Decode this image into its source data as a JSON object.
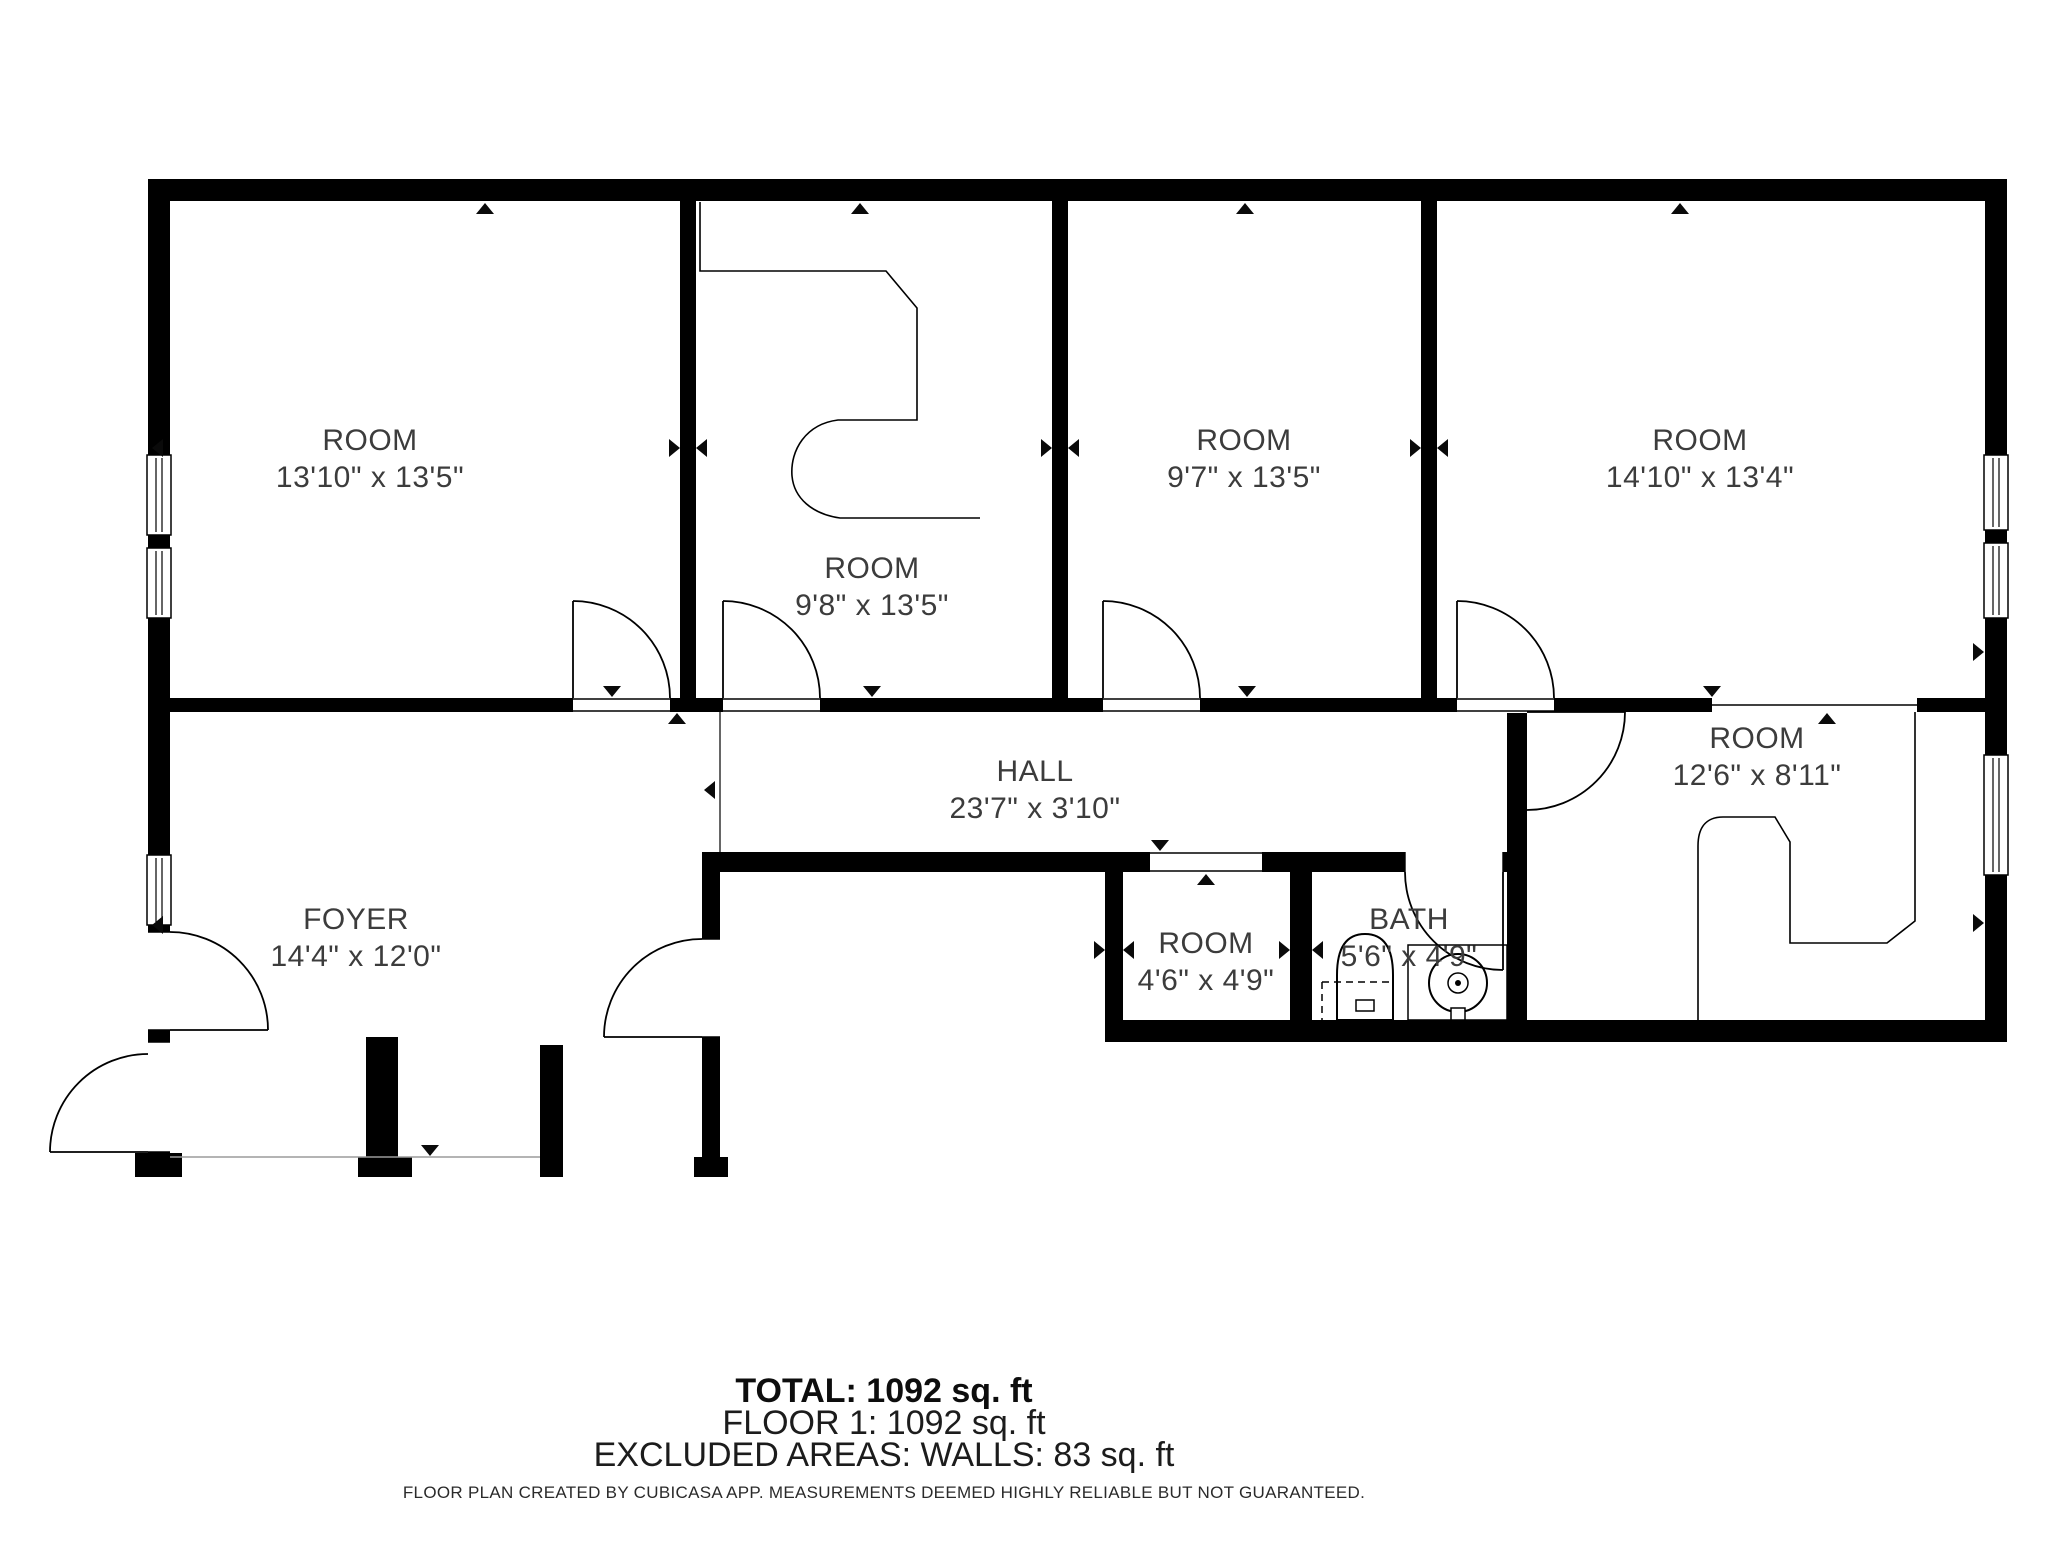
{
  "plan": {
    "rooms": [
      {
        "name": "ROOM",
        "dims": "13'10\" x 13'5\""
      },
      {
        "name": "ROOM",
        "dims": "9'8\" x 13'5\""
      },
      {
        "name": "ROOM",
        "dims": "9'7\" x 13'5\""
      },
      {
        "name": "ROOM",
        "dims": "14'10\" x 13'4\""
      },
      {
        "name": "HALL",
        "dims": "23'7\" x 3'10\""
      },
      {
        "name": "FOYER",
        "dims": "14'4\" x 12'0\""
      },
      {
        "name": "ROOM",
        "dims": "4'6\" x 4'9\""
      },
      {
        "name": "BATH",
        "dims": "5'6\" x 4'9\""
      },
      {
        "name": "ROOM",
        "dims": "12'6\" x 8'11\""
      }
    ],
    "wall_color": "#000000",
    "text_color": "#3c3c3c"
  },
  "footer": {
    "total": "TOTAL: 1092 sq. ft",
    "floor": "FLOOR 1: 1092 sq. ft",
    "excluded": "EXCLUDED AREAS: WALLS: 83 sq. ft",
    "disclaimer": "FLOOR PLAN CREATED BY CUBICASA APP. MEASUREMENTS DEEMED HIGHLY RELIABLE BUT NOT GUARANTEED."
  }
}
